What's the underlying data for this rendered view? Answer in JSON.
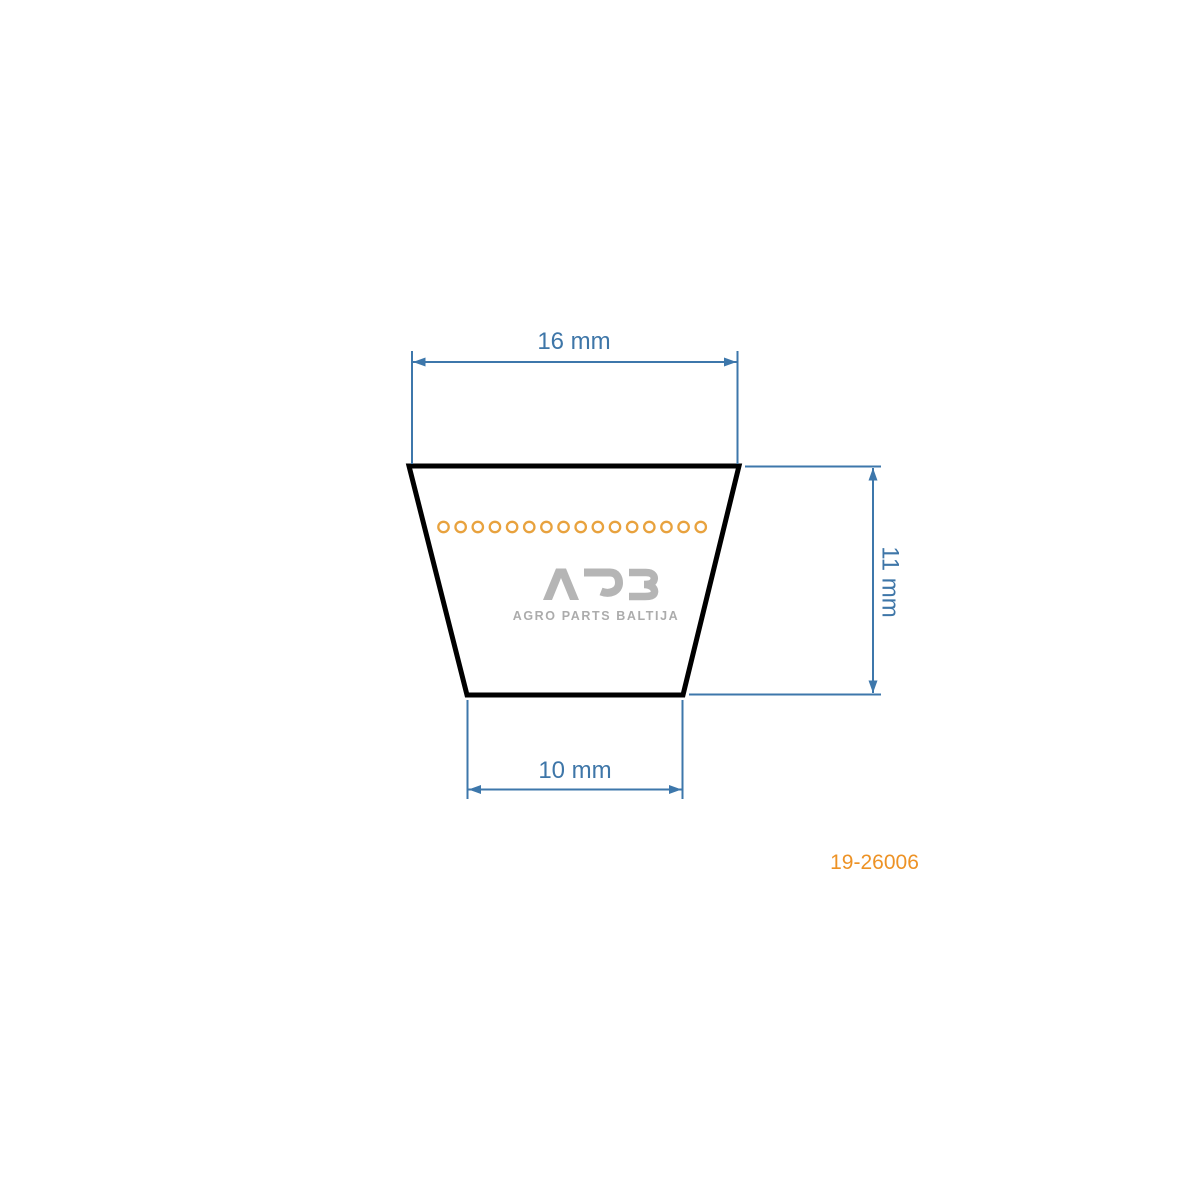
{
  "page": {
    "background": "#FFFFFF"
  },
  "diagram": {
    "type": "v-belt cross-section technical drawing",
    "dimensions": {
      "top_width_label": "16 mm",
      "height_label": "11 mm",
      "bottom_width_label": "10 mm"
    },
    "cord_circle_count": 16,
    "logo": {
      "text": "APB",
      "subtext": "AGRO PARTS BALTIJA"
    },
    "part_number": "19-26006"
  },
  "colors": {
    "dimension_text": "#3E76A8",
    "dimension_line": "#3D77AB",
    "belt_outline": "#000000",
    "cord_ring": "#E8A23E",
    "part_number": "#ED9225",
    "logo_gray": "#B5B5B5",
    "logo_subtext_gray": "#ACACAC"
  }
}
